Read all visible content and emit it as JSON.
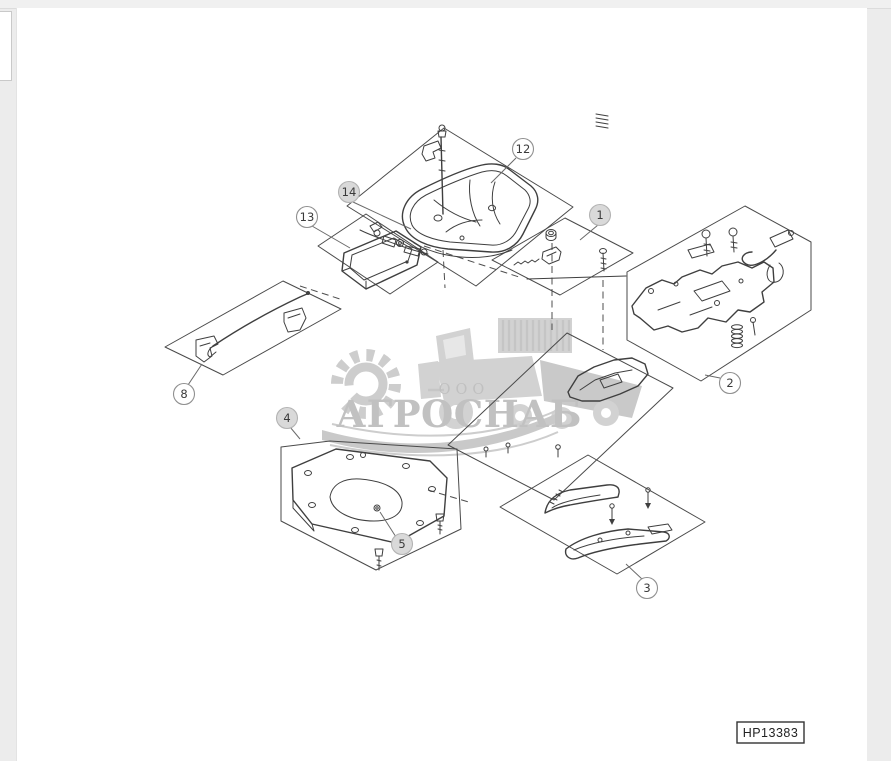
{
  "page": {
    "background_color": "#ececec",
    "sheet_color": "#ffffff",
    "part_label": "HP13383"
  },
  "watermark": {
    "org_prefix": "ООО",
    "org_name": "АГРОСНАБ",
    "logo_icons": [
      "gear-icon",
      "combine-harvester-icon"
    ],
    "color": "#c1c1c1"
  },
  "diagram": {
    "type": "exploded-parts-drawing",
    "line_color": "#3f3f3f",
    "callouts": [
      {
        "label": "12"
      },
      {
        "label": "14"
      },
      {
        "label": "13"
      },
      {
        "label": "1"
      },
      {
        "label": "2"
      },
      {
        "label": "8"
      },
      {
        "label": "4"
      },
      {
        "label": "5"
      },
      {
        "label": "3"
      }
    ]
  }
}
